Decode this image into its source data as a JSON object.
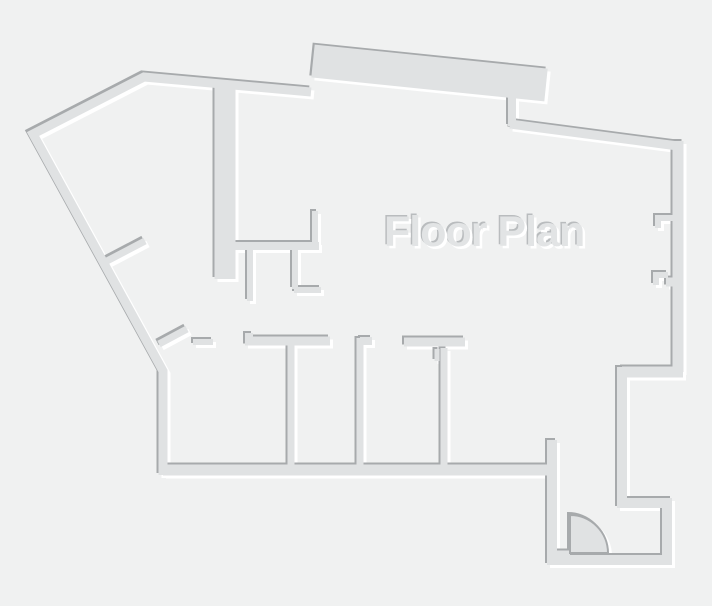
{
  "canvas": {
    "width": 712,
    "height": 606,
    "background_color": "#f0f1f1"
  },
  "title": {
    "text": "Floor Plan",
    "color": "#e2e4e5",
    "shadow_dark": "#b9bcbe",
    "x": 384,
    "y": 211,
    "font_size_px": 43
  },
  "palette": {
    "wall_fill": "#e0e2e3",
    "emboss_dark": "#a7aaac",
    "emboss_light": "#ffffff",
    "emboss_dark_offset": [
      -2,
      -2
    ],
    "emboss_light_offset": [
      3,
      3
    ]
  },
  "walls": [
    {
      "name": "outer-left",
      "width": 9,
      "points": [
        [
          163,
          475
        ],
        [
          163,
          371
        ],
        [
          33,
          134
        ],
        [
          144,
          77
        ],
        [
          311,
          92
        ]
      ]
    },
    {
      "name": "slab-top",
      "width": 33,
      "points": [
        [
          313,
          61
        ],
        [
          546,
          85
        ]
      ]
    },
    {
      "name": "slab-step",
      "width": 8,
      "points": [
        [
          512,
          97
        ],
        [
          512,
          126
        ]
      ]
    },
    {
      "name": "outer-top-right",
      "width": 9,
      "points": [
        [
          510,
          124
        ],
        [
          678,
          146
        ]
      ]
    },
    {
      "name": "outer-right",
      "width": 11,
      "points": [
        [
          678,
          141
        ],
        [
          678,
          372
        ]
      ]
    },
    {
      "name": "jog-right",
      "width": 11,
      "points": [
        [
          683,
          372
        ],
        [
          622,
          372
        ]
      ]
    },
    {
      "name": "room-right-west",
      "width": 10,
      "points": [
        [
          622,
          367
        ],
        [
          622,
          503
        ]
      ]
    },
    {
      "name": "corridor-north",
      "width": 10,
      "points": [
        [
          617,
          503
        ],
        [
          667,
          503
        ]
      ]
    },
    {
      "name": "corridor-east",
      "width": 10,
      "points": [
        [
          667,
          498
        ],
        [
          667,
          560
        ]
      ]
    },
    {
      "name": "outer-bottom-right",
      "width": 10,
      "points": [
        [
          672,
          560
        ],
        [
          552,
          560
        ]
      ]
    },
    {
      "name": "entry-step",
      "width": 10,
      "points": [
        [
          552,
          565
        ],
        [
          552,
          440
        ]
      ]
    },
    {
      "name": "door-threshold",
      "width": 9,
      "points": [
        [
          552,
          555
        ],
        [
          570,
          555
        ]
      ]
    },
    {
      "name": "outer-bottom",
      "width": 11,
      "points": [
        [
          547,
          470
        ],
        [
          163,
          470
        ]
      ]
    },
    {
      "name": "upper-core",
      "width": 21,
      "points": [
        [
          225,
          84
        ],
        [
          225,
          279
        ]
      ]
    },
    {
      "name": "core-east-wall",
      "width": 8,
      "points": [
        [
          231,
          246
        ],
        [
          319,
          246
        ]
      ]
    },
    {
      "name": "core-stub-north",
      "width": 6,
      "points": [
        [
          315,
          211
        ],
        [
          315,
          248
        ]
      ]
    },
    {
      "name": "closet-wall-a",
      "width": 6,
      "points": [
        [
          250,
          249
        ],
        [
          250,
          301
        ]
      ]
    },
    {
      "name": "closet-wall-b",
      "width": 6,
      "points": [
        [
          295,
          249
        ],
        [
          295,
          289
        ]
      ]
    },
    {
      "name": "closet-stub",
      "width": 6,
      "points": [
        [
          294,
          290
        ],
        [
          321,
          290
        ]
      ]
    },
    {
      "name": "jamb-upper",
      "width": 7,
      "points": [
        [
          105,
          262
        ],
        [
          145,
          241
        ]
      ]
    },
    {
      "name": "jamb-lower",
      "width": 7,
      "points": [
        [
          159,
          344
        ],
        [
          187,
          329
        ]
      ]
    },
    {
      "name": "jamb-stub",
      "width": 6,
      "points": [
        [
          193,
          342
        ],
        [
          213,
          342
        ]
      ]
    },
    {
      "name": "room1-step",
      "width": 8,
      "points": [
        [
          249,
          333
        ],
        [
          249,
          341
        ]
      ]
    },
    {
      "name": "room1-north",
      "width": 9,
      "points": [
        [
          245,
          341
        ],
        [
          330,
          341
        ]
      ]
    },
    {
      "name": "room-divider-1",
      "width": 7,
      "points": [
        [
          291,
          345
        ],
        [
          291,
          470
        ]
      ]
    },
    {
      "name": "room-divider-2",
      "width": 7,
      "points": [
        [
          360,
          338
        ],
        [
          360,
          470
        ]
      ]
    },
    {
      "name": "divider2-flange",
      "width": 8,
      "points": [
        [
          360,
          341
        ],
        [
          372,
          341
        ]
      ]
    },
    {
      "name": "room2-north",
      "width": 9,
      "points": [
        [
          404,
          342
        ],
        [
          465,
          342
        ]
      ]
    },
    {
      "name": "divider3-tick",
      "width": 5,
      "points": [
        [
          437,
          349
        ],
        [
          437,
          361
        ]
      ]
    },
    {
      "name": "room-divider-3",
      "width": 7,
      "points": [
        [
          444,
          348
        ],
        [
          444,
          467
        ]
      ]
    },
    {
      "name": "window-notch-1",
      "width": 6,
      "points": [
        [
          658,
          228
        ],
        [
          658,
          218
        ],
        [
          674,
          218
        ]
      ]
    },
    {
      "name": "window-notch-2",
      "width": 6,
      "points": [
        [
          656,
          285
        ],
        [
          656,
          275
        ],
        [
          668,
          275
        ]
      ]
    },
    {
      "name": "window-notch-2b",
      "width": 9,
      "points": [
        [
          666,
          282
        ],
        [
          675,
          282
        ]
      ]
    }
  ],
  "door": {
    "name": "entry-door",
    "hinge": [
      570,
      553
    ],
    "leaf_top": [
      570,
      515
    ],
    "radius": 38,
    "arc_end": [
      608,
      553
    ],
    "stroke_width": 2
  }
}
